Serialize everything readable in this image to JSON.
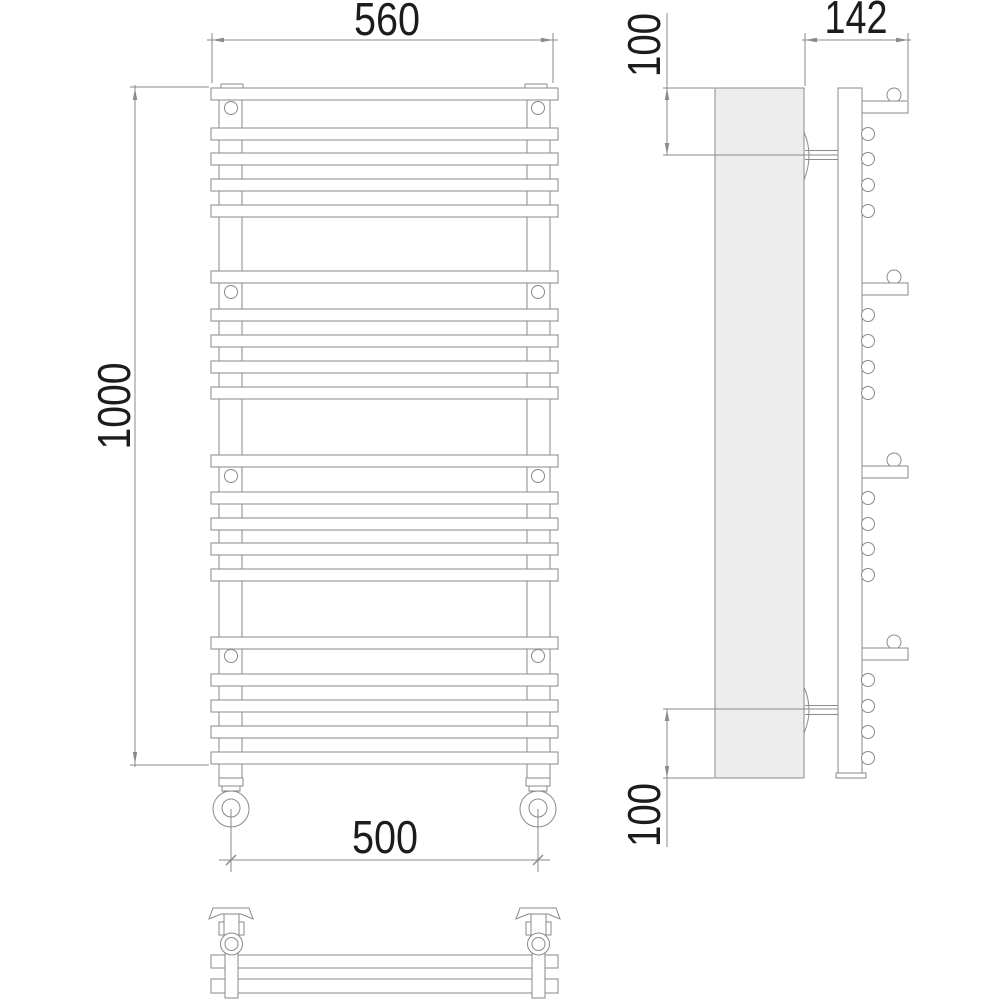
{
  "drawing": {
    "kind": "towel-rail-technical-drawing",
    "views": [
      "front",
      "side",
      "top"
    ]
  },
  "dims": {
    "front_width": "560",
    "front_height": "1000",
    "valve_spacing": "500",
    "side_depth": "142",
    "side_top_offset": "100",
    "side_bottom_offset": "100"
  },
  "colors": {
    "line": "#8a8a8a",
    "text": "#1c1c1c",
    "panel_fill": "#ededed",
    "background": "#ffffff"
  },
  "geometry": {
    "front_bar_tops": [
      88,
      128,
      153,
      179,
      205,
      271,
      309,
      335,
      361,
      387,
      455,
      492,
      518,
      543,
      569,
      637,
      674,
      700,
      726,
      752
    ],
    "front_screw_rows": [
      108,
      292,
      476,
      656
    ],
    "front_screw_cx": [
      231,
      538
    ],
    "side_bar_circle_cy": [
      134,
      159,
      185,
      211,
      315,
      341,
      367,
      393,
      498,
      524,
      549,
      575,
      680,
      706,
      732,
      758
    ],
    "side_bracket_tops": [
      101,
      283,
      466,
      648
    ]
  }
}
